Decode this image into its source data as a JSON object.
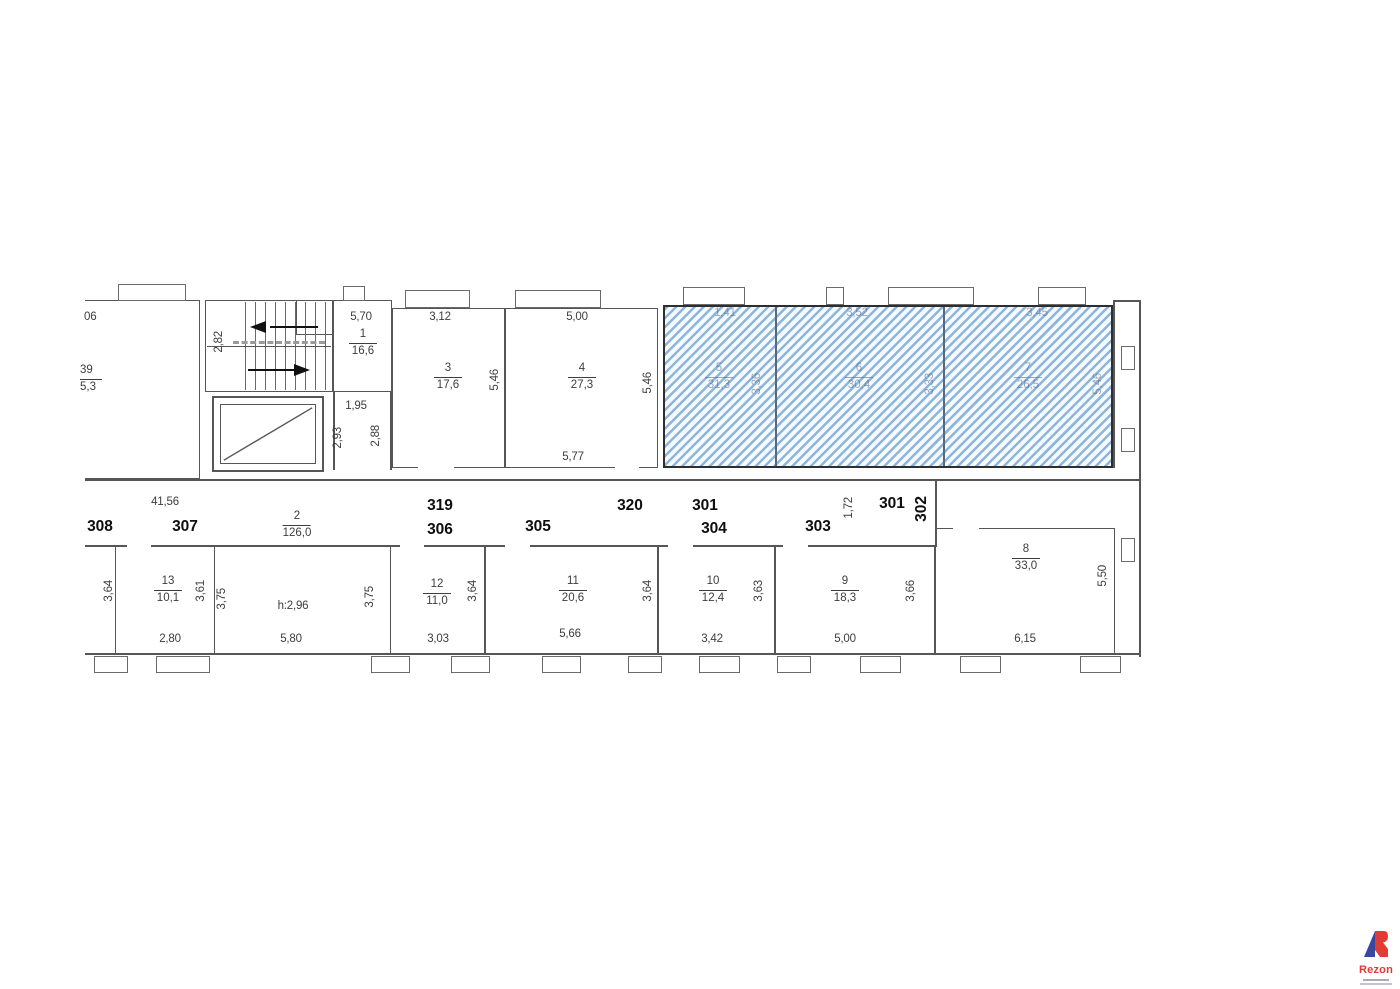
{
  "colors": {
    "hatch_blue": "#8cb6dd",
    "wall_gray": "#565656",
    "logo_red": "#e23b34",
    "logo_blue": "#3a479e"
  },
  "rooms": {
    "r39": {
      "num": "39",
      "area": "5,3"
    },
    "r1": {
      "num": "1",
      "area": "16,6"
    },
    "r2": {
      "num": "2",
      "area": "126,0"
    },
    "r3": {
      "num": "3",
      "area": "17,6"
    },
    "r4": {
      "num": "4",
      "area": "27,3"
    },
    "r5": {
      "num": "5",
      "area": "31,3"
    },
    "r6": {
      "num": "6",
      "area": "30,4"
    },
    "r7": {
      "num": "7",
      "area": "26,5"
    },
    "r8": {
      "num": "8",
      "area": "33,0"
    },
    "r9": {
      "num": "9",
      "area": "18,3"
    },
    "r10": {
      "num": "10",
      "area": "12,4"
    },
    "r11": {
      "num": "11",
      "area": "20,6"
    },
    "r12": {
      "num": "12",
      "area": "11,0"
    },
    "r13": {
      "num": "13",
      "area": "10,1"
    }
  },
  "units": {
    "u308": "308",
    "u307": "307",
    "u319": "319",
    "u306": "306",
    "u305": "305",
    "u320": "320",
    "u301a": "301",
    "u304": "304",
    "u303": "303",
    "u301b": "301",
    "u302": "302"
  },
  "dims": {
    "partial_top": "06",
    "stair_w": "2,82",
    "r1_top": "5,70",
    "r3_top": "3,12",
    "r4_top": "5,00",
    "r3_r": "5,46",
    "r4_r": "5,46",
    "r4_b": "5,77",
    "lobby": "1,95",
    "lobby_l": "2,93",
    "lobby_r": "2,88",
    "h5_t": "1,41",
    "h6_t": "3,52",
    "h7_t": "3,45",
    "h5_r": "3,36",
    "h6_r": "3,33",
    "h7_r": "5,46",
    "corr": "41,56",
    "c172": "1,72",
    "b364": "3,64",
    "r13_r": "3,61",
    "r13_b": "2,80",
    "c375a": "3,75",
    "c375b": "3,75",
    "r2_h": "h:2,96",
    "r2_b": "5,80",
    "r12_r": "3,64",
    "r12_b": "3,03",
    "r11_r": "3,64",
    "r11_b": "5,66",
    "r10_r": "3,63",
    "r10_b": "3,42",
    "r9_r": "3,66",
    "r9_b": "5,00",
    "r8_r": "5,50",
    "r8_b": "6,15"
  },
  "logo": {
    "brand": "Rezon"
  }
}
